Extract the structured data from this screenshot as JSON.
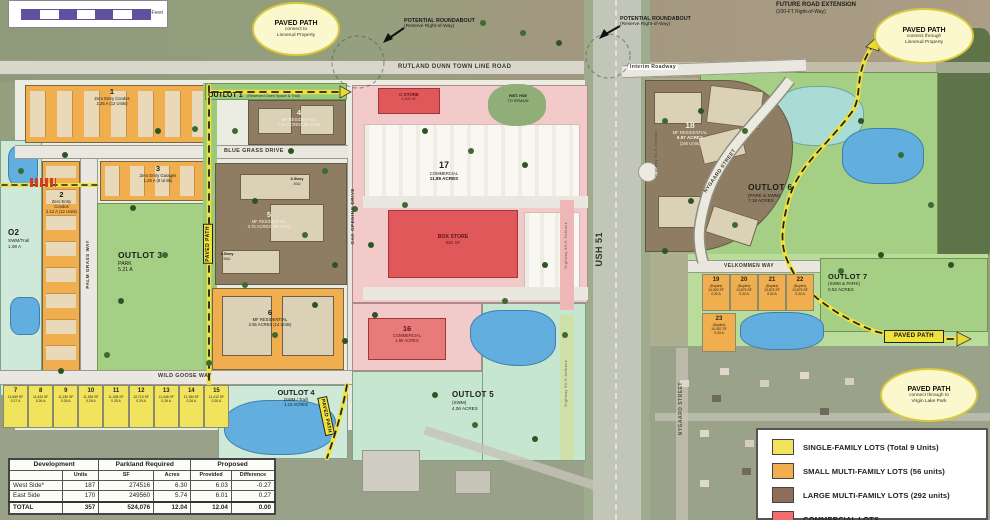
{
  "colors": {
    "single_family": "#f2e35c",
    "small_multi_family": "#f0ae4e",
    "large_multi_family": "#8e7d62",
    "commercial_parking": "#f2caca",
    "commercial_building": "#e0585a",
    "park_green": "#a5cf85",
    "swm_teal": "#cfe9d9",
    "water_blue": "#62aede",
    "path_yellow": "#f0e23c",
    "scalebar_purple": "#5f51a0"
  },
  "scalebar": {
    "label": "Feet"
  },
  "callouts": {
    "nw": {
      "title": "PAVED PATH",
      "l1": "connect to",
      "l2": "Linnerud Property"
    },
    "ne": {
      "title": "PAVED PATH",
      "l1": "connect through",
      "l2": "Linnerud Property"
    },
    "se": {
      "title": "PAVED PATH",
      "l1": "connect through to",
      "l2": "Virgin Lake Park"
    }
  },
  "annotations": {
    "roundabout": {
      "l1": "POTENTIAL ROUNDABOUT",
      "l2": "(Reserve Right-of-Way)"
    },
    "future_road": {
      "l1": "FUTURE ROAD EXTENSION",
      "l2": "(100-FT Right-of-Way)"
    },
    "hist_house": {
      "l1": "HIST. HSE",
      "l2": "TO REMAIN"
    },
    "setback": "Highway 50-ft Setback",
    "paved_path": "PAVED PATH"
  },
  "roads": {
    "rutland": "RUTLAND DUNN TOWN LINE ROAD",
    "ush51": "USH 51",
    "interim": "Interim Roadway",
    "blue_grass": "BLUE GRASS DRIVE",
    "palm_grass": "PALM GRASS WAY",
    "oak_opening": "OAK OPENING DRIVE",
    "wild_goose": "WILD GOOSE WAY",
    "velkommen": "VELKOMMEN WAY",
    "nygaard": "NYGAARD STREET"
  },
  "lots": {
    "l1": {
      "num": "1",
      "name": "Zero Entry Condos",
      "area": "2.26 A (12 Units)"
    },
    "l2": {
      "num": "2",
      "name": "Zero Entry Condos",
      "area": "2.12 A (12 Units)"
    },
    "l3": {
      "num": "3",
      "name": "Zero Entry Garages",
      "area": "1.26 A (8 Units)"
    },
    "l4": {
      "num": "4",
      "name": "MF RESIDENTIAL",
      "area": "1.51 ACRES (36 Units)"
    },
    "l5": {
      "num": "5",
      "name": "MF RESIDENTIAL",
      "area": "3.75 ACRES (96 Units)"
    },
    "l6": {
      "num": "6",
      "name": "MF RESIDENTIAL",
      "area": "2.55 ACRES (14 Units)"
    },
    "l16": {
      "num": "16",
      "name": "COMMERCIAL",
      "area": "1.99 ACRES"
    },
    "l17": {
      "num": "17",
      "name": "COMMERCIAL",
      "area": "11.89 ACRES"
    },
    "l18": {
      "num": "18",
      "name": "MF RESIDENTIAL",
      "area": "6.97 ACRES",
      "units": "(160 Units)"
    }
  },
  "sf_lots": [
    {
      "num": "7",
      "sf": "11,659 SF",
      "ac": "0.27 A"
    },
    {
      "num": "8",
      "sf": "11,443 SF",
      "ac": "0.26 A"
    },
    {
      "num": "9",
      "sf": "11,230 SF",
      "ac": "0.26 A"
    },
    {
      "num": "10",
      "sf": "11,189 SF",
      "ac": "0.26 A"
    },
    {
      "num": "11",
      "sf": "11,028 SF",
      "ac": "0.25 A"
    },
    {
      "num": "12",
      "sf": "12,713 SF",
      "ac": "0.29 A"
    },
    {
      "num": "13",
      "sf": "11,345 SF",
      "ac": "0.26 A"
    },
    {
      "num": "14",
      "sf": "11,184 SF",
      "ac": "0.26 A"
    },
    {
      "num": "15",
      "sf": "11,412 SF",
      "ac": "0.26 A"
    }
  ],
  "duplex_lots": [
    {
      "num": "19",
      "sub": "(Duplex)",
      "sf": "14,000 SF",
      "ac": "0.32 A"
    },
    {
      "num": "20",
      "sub": "(Duplex)",
      "sf": "13,875 SF",
      "ac": "0.32 A"
    },
    {
      "num": "21",
      "sub": "(Duplex)",
      "sf": "13,875 SF",
      "ac": "0.32 A"
    },
    {
      "num": "22",
      "sub": "(Duplex)",
      "sf": "13,875 SF",
      "ac": "0.32 A"
    },
    {
      "num": "23",
      "sub": "(Duplex)",
      "sf": "14,307 SF",
      "ac": "0.33 A"
    }
  ],
  "outlots": {
    "o1": {
      "name": "OUTLOT 1",
      "desc": "(Reserved Open Space & Trail)"
    },
    "o2": {
      "name": "O2",
      "d1": "SWM/Trail",
      "d2": "1.08 A"
    },
    "o3": {
      "name": "OUTLOT 3",
      "d1": "PARK",
      "d2": "5.21 A"
    },
    "o4": {
      "name": "OUTLOT 4",
      "d1": "(SWM / Trail)",
      "d2": "1.13 ACRES"
    },
    "o5": {
      "name": "OUTLOT 5",
      "d1": "(SWM)",
      "d2": "4.06 ACRES"
    },
    "o6": {
      "name": "OUTLOT 6",
      "d1": "(PARK & SWM)",
      "d2": "7.18 ACRES"
    },
    "o7": {
      "name": "OUTLOT 7",
      "d1": "(SWM & PARK)",
      "d2": "0.52 ACRES"
    }
  },
  "buildings": {
    "box_store": {
      "l1": "BOX STORE",
      "l2": "92K SF"
    },
    "c_store": {
      "l1": "C-STORE",
      "l2": "4,000 SF"
    },
    "s40": {
      "l1": "3-Story",
      "l2": "40U"
    },
    "s56": {
      "l1": "3-Story",
      "l2": "56U"
    }
  },
  "legend": {
    "items": [
      {
        "label": "SINGLE-FAMILY LOTS (Total 9 Units)",
        "color": "#f2e35c"
      },
      {
        "label": "SMALL MULTI-FAMILY LOTS (56 units)",
        "color": "#f0ae4e"
      },
      {
        "label": "LARGE MULTI-FAMILY LOTS (292 units)",
        "color": "#8e6e59"
      },
      {
        "label": "COMMERCIAL LOTS",
        "color": "#f26d6d"
      }
    ]
  },
  "table": {
    "col_groups": [
      "Development",
      "Parkland Required",
      "Proposed"
    ],
    "subheaders": [
      "",
      "Units",
      "SF",
      "Acres",
      "Provided",
      "Difference"
    ],
    "rows": [
      {
        "name": "West Side*",
        "units": "187",
        "sf": "274516",
        "acres": "6.30",
        "provided": "6.03",
        "difference": "-0.27"
      },
      {
        "name": "East Side",
        "units": "170",
        "sf": "249560",
        "acres": "5.74",
        "provided": "6.01",
        "difference": "0.27"
      },
      {
        "name": "TOTAL",
        "units": "357",
        "sf": "524,076",
        "acres": "12.04",
        "provided": "12.04",
        "difference": "0.00"
      }
    ]
  }
}
